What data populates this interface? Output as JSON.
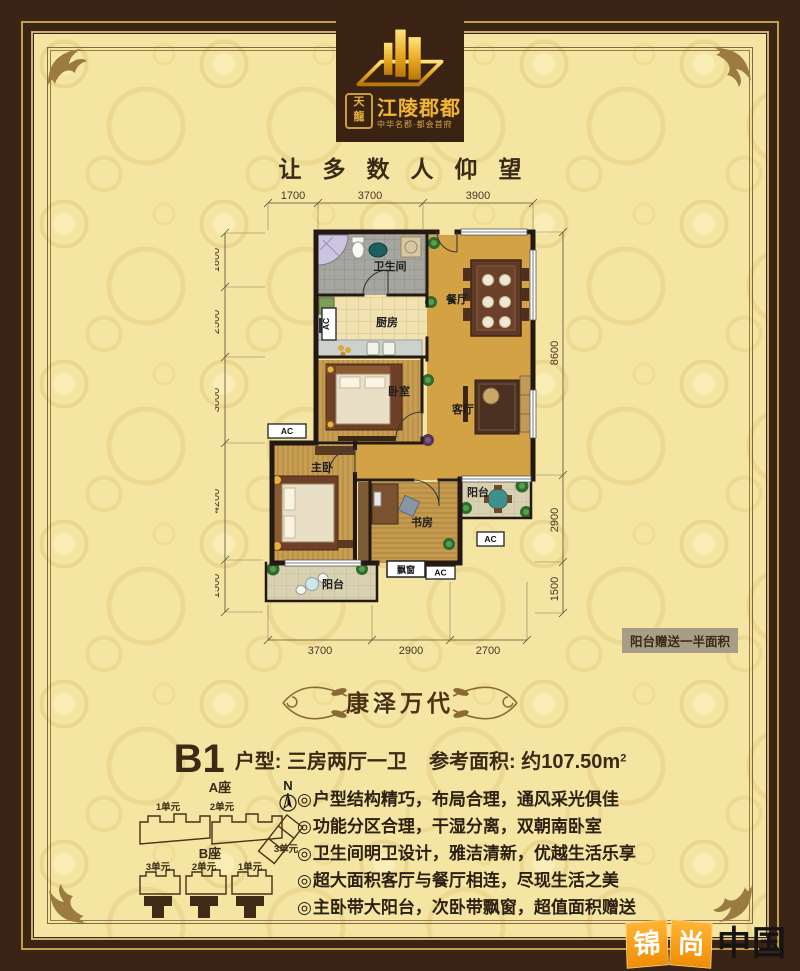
{
  "brand": {
    "seal_top": "天",
    "seal_bottom": "龍",
    "name": "江陵郡都",
    "subtitle": "中华名郡·都会首府",
    "slogan": "让多数人仰望"
  },
  "floorplan": {
    "rooms": {
      "bathroom": "卫生间",
      "kitchen": "厨房",
      "dining": "餐厅",
      "bedroom": "卧室",
      "living": "客厅",
      "master": "主卧",
      "study": "书房",
      "balcony_right": "阳台",
      "balcony_left": "阳台",
      "bay_window": "飘窗",
      "ac": "AC"
    },
    "dims": {
      "top": [
        "1700",
        "3700",
        "3900"
      ],
      "left": [
        "1800",
        "2500",
        "3000",
        "4200",
        "1500"
      ],
      "right": [
        "8600",
        "2900",
        "1500"
      ],
      "bottom": [
        "3700",
        "2900",
        "2700"
      ]
    },
    "note": "阳台赠送一半面积"
  },
  "section_title": "康泽万代",
  "unit": {
    "code": "B1",
    "type_label": "户型: 三房两厅一卫",
    "area_label": "参考面积: 约107.50m",
    "area_sup": "2"
  },
  "site_plan": {
    "block_a": "A座",
    "block_b": "B座",
    "a_units": [
      "1单元",
      "2单元",
      "3单元"
    ],
    "b_units": [
      "3单元",
      "2单元",
      "1单元"
    ],
    "north": "N"
  },
  "features_bullet": "◎",
  "features": [
    "户型结构精巧，布局合理，通风采光俱佳",
    "功能分区合理，干湿分离，双朝南卧室",
    "卫生间明卫设计，雅洁清新，优越生活乐享",
    "超大面积客厅与餐厅相连，尽现生活之美",
    "主卧带大阳台，次卧带飘窗，超值面积赠送"
  ],
  "watermark": {
    "char1": "锦",
    "char2": "尚",
    "rest": "中国"
  }
}
